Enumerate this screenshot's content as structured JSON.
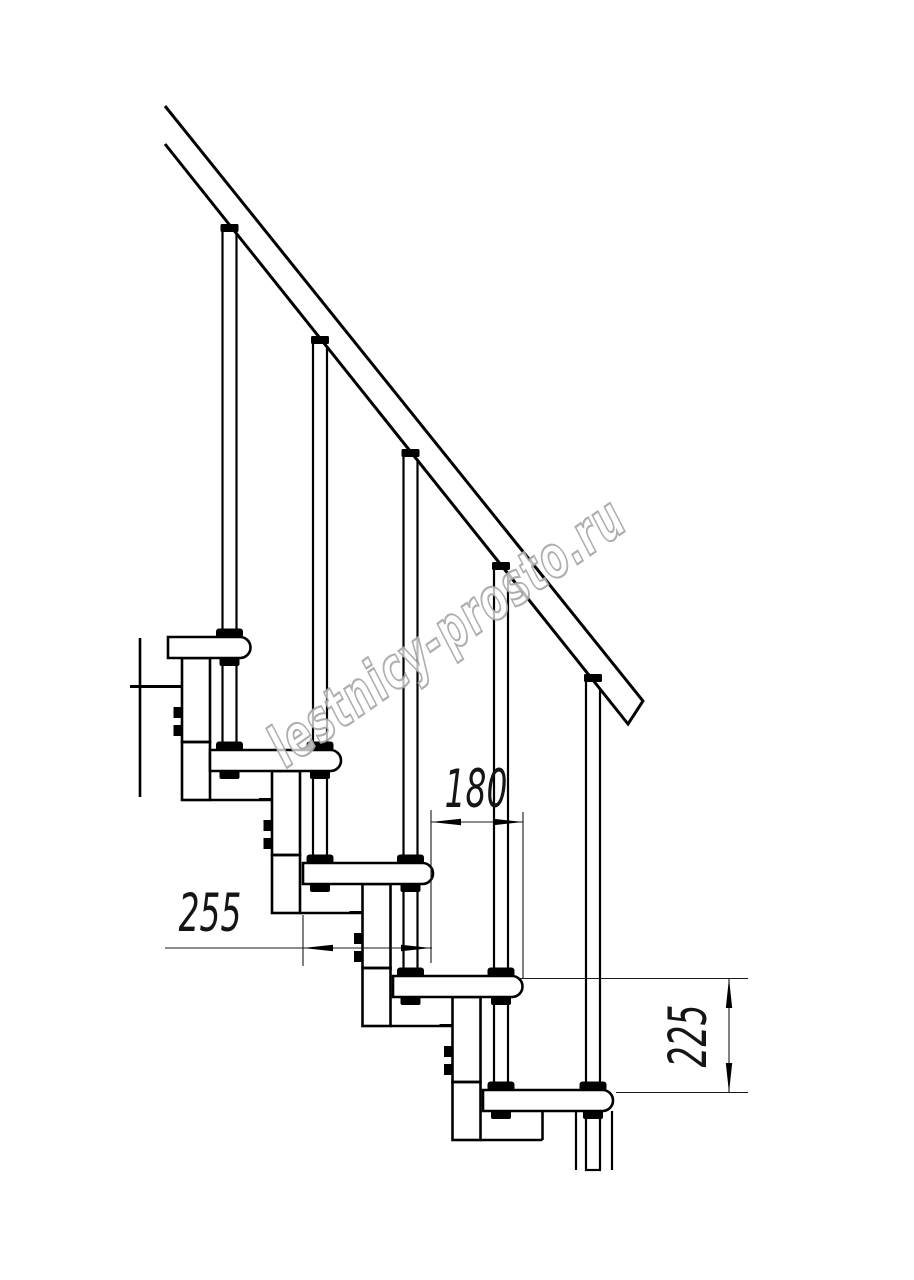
{
  "drawing": {
    "title": "modular-staircase-side-elevation",
    "watermark": {
      "text": "lestnicy-prosto.ru",
      "fill_color": "#ffffff",
      "outline_color": "#a5a5a5"
    },
    "dimensions": {
      "tread_depth": {
        "value": "255",
        "orientation": "horizontal"
      },
      "step_run": {
        "value": "180",
        "orientation": "horizontal"
      },
      "step_rise": {
        "value": "225",
        "orientation": "vertical"
      }
    },
    "colors": {
      "line": "#000000",
      "dim_line": "#1a1a1a",
      "background": "#ffffff"
    },
    "counts": {
      "treads_visible": 5,
      "balusters_visible": 5,
      "support_modules_visible": 4
    }
  }
}
